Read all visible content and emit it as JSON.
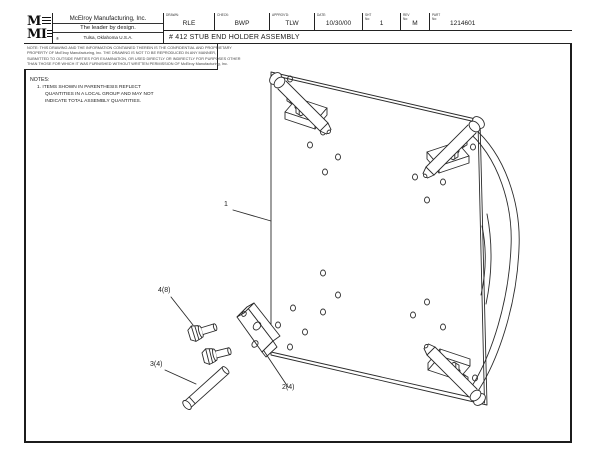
{
  "colors": {
    "line": "#2b2b2b",
    "background": "#ffffff",
    "border": "#1c1c1c"
  },
  "title_block": {
    "logo": {
      "top": "M",
      "bottom": "MI"
    },
    "company_name": "McElroy Manufacturing, Inc.",
    "tagline": "The leader by design.",
    "registered_mark": "®",
    "location": "Tulsa, Oklahoma U.S.A.",
    "fields": [
      {
        "label": "DRAWN:",
        "value": "RLE"
      },
      {
        "label": "CHECK:",
        "value": "BWP"
      },
      {
        "label": "APPROV'D:",
        "value": "TLW"
      },
      {
        "label": "DATE:",
        "value": "10/30/00"
      },
      {
        "label": "SHT No:",
        "value": "1"
      },
      {
        "label": "REV No:",
        "value": "M"
      },
      {
        "label": "PART No:",
        "value": "1214601"
      }
    ],
    "drawing_title": "# 412 STUB END HOLDER ASSEMBLY",
    "proprietary_note": [
      "NOTE: THIS DRAWING AND THE INFORMATION CONTAINED THEREIN IS THE CONFIDENTIAL AND PROPRIETARY",
      "PROPERTY OF McElroy Manufacturing, Inc.  THE DRAWING IS NOT TO BE REPRODUCED IN ANY MANNER,",
      "SUBMITTED TO OUTSIDE PARTIES FOR EXAMINATION, OR USED DIRECTLY OR INDIRECTLY FOR PURPOSES OTHER",
      "THAN THOSE FOR WHICH IT WAS FURNISHED WITHOUT WRITTEN PERMISSION OF McElroy Manufacturing, Inc."
    ]
  },
  "notes": {
    "heading": "NOTES:",
    "items": [
      {
        "number": "1.",
        "text": "ITEMS SHOWN IN PARENTHESIS REFLECT QUANTITIES IN A LOCAL GROUP AND MAY NOT INDICATE TOTAL ASSEMBLY QUANTITIES."
      }
    ]
  },
  "callouts": [
    {
      "id": "1"
    },
    {
      "id": "2(4)"
    },
    {
      "id": "3(4)"
    },
    {
      "id": "4(8)"
    }
  ]
}
